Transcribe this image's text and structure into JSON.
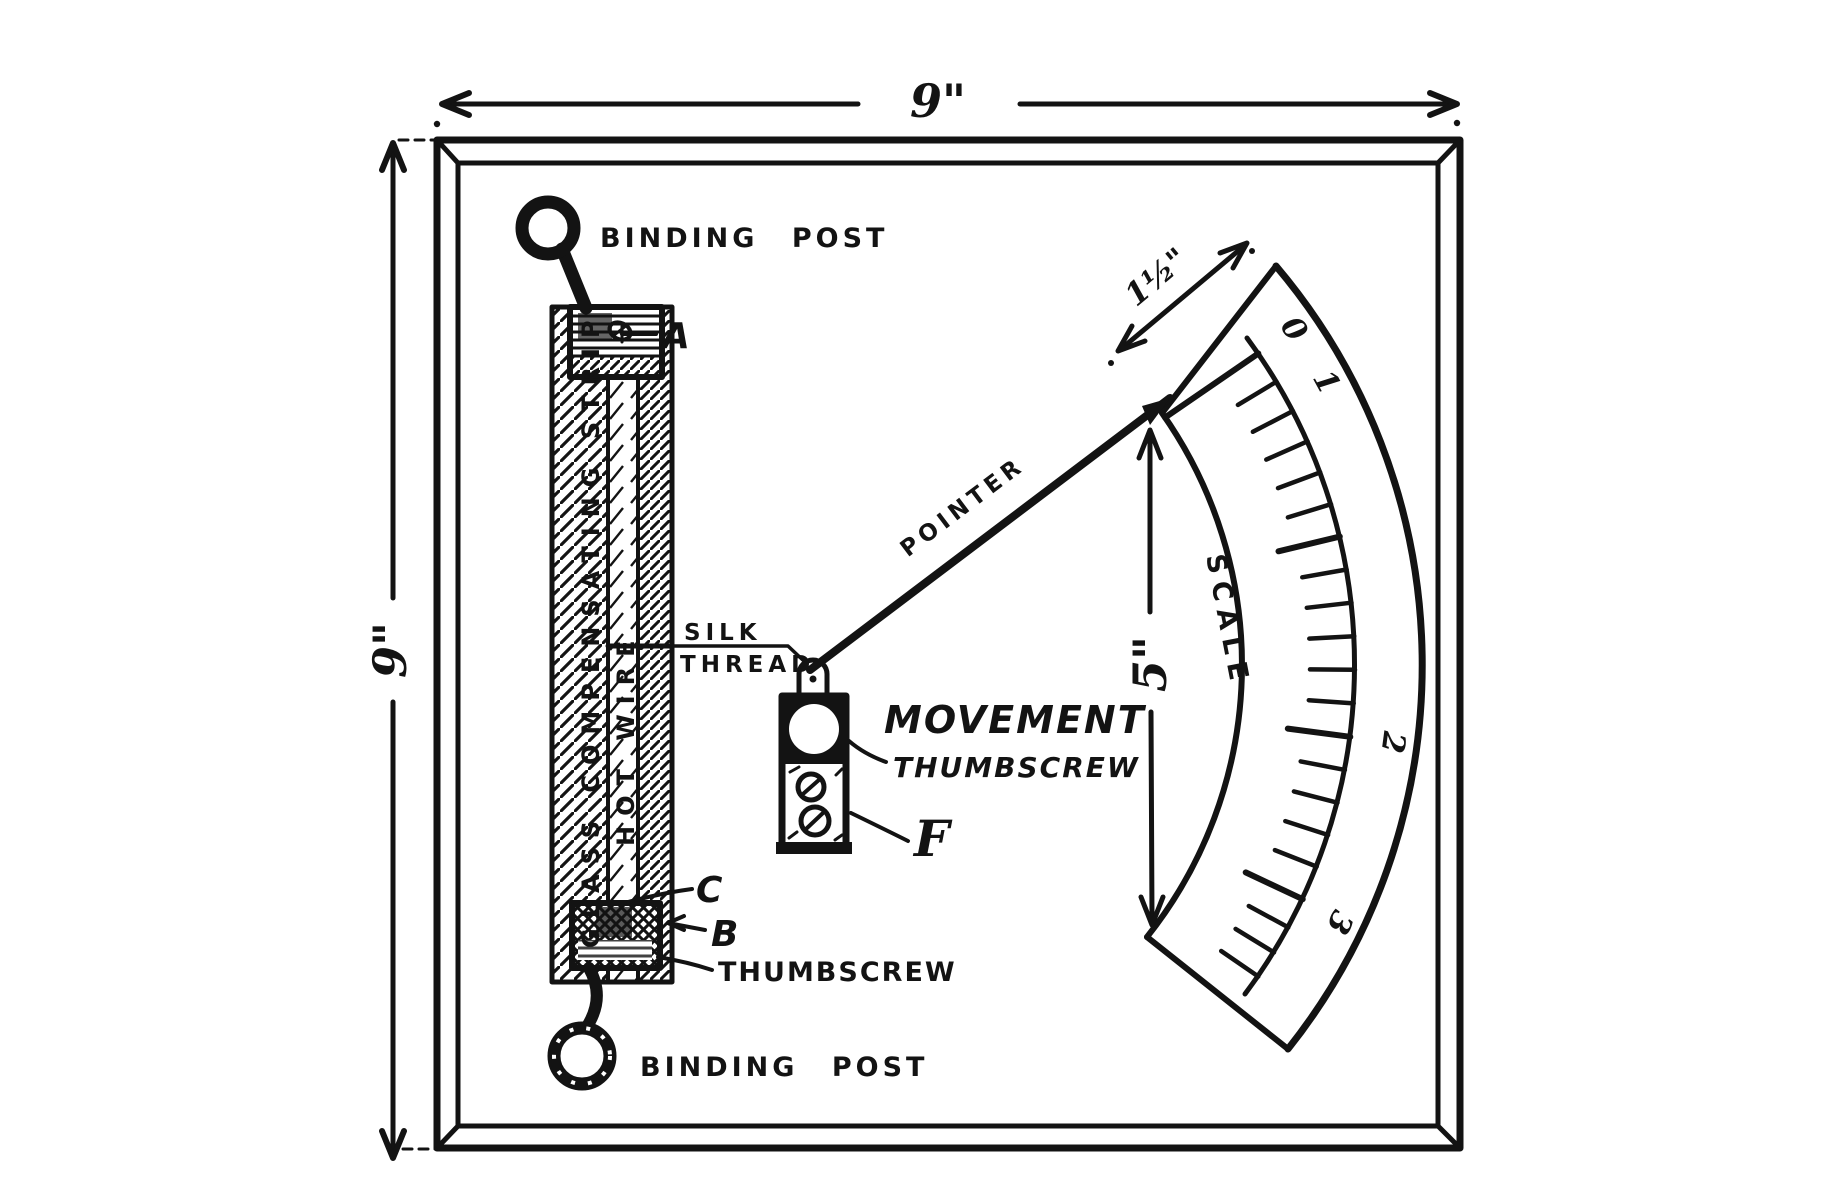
{
  "colors": {
    "ink": "#131313",
    "paper": "#ffffff"
  },
  "dimensions": {
    "board_width": "9\"",
    "board_height": "9\"",
    "scale_band_width": "1½\"",
    "scale_height": "5\""
  },
  "labels": {
    "binding_post_top": "BINDING POST",
    "binding_post_bottom": "BINDING POST",
    "label_a": "A",
    "label_b": "B",
    "label_c": "C",
    "label_f": "F",
    "glass_strip_vertical": "GLASS COMPENSATING STRIP",
    "hot_wire_vertical": "HOT WIRE",
    "silk_line1": "SILK",
    "silk_line2": "THREAD",
    "pointer": "POINTER",
    "movement_line1": "MOVEMENT",
    "movement_line2": "THUMBSCREW",
    "thumbscrew_bottom": "THUMBSCREW",
    "scale_label": "SCALE"
  },
  "scale_markings": {
    "numbers": [
      "0",
      "1",
      "2",
      "3"
    ],
    "number_angles_deg": [
      -34.5,
      -28.5,
      7.5,
      25.7
    ],
    "tick_angles_deg": [
      -34.5,
      -31,
      -27.5,
      -24,
      -20.5,
      -17,
      -13.5,
      -10,
      -6.5,
      -3,
      0.5,
      4,
      7.5,
      11,
      14.5,
      18,
      21.5,
      25.2,
      28.5,
      31.5,
      34.5
    ],
    "major_tick_angles_deg": [
      -34.5,
      -13.5,
      7.5,
      25.2
    ],
    "center": {
      "x": 805,
      "y": 665
    },
    "radii": {
      "inner": 437,
      "tick_base": 550,
      "numbers": 583,
      "outer": 617
    }
  }
}
